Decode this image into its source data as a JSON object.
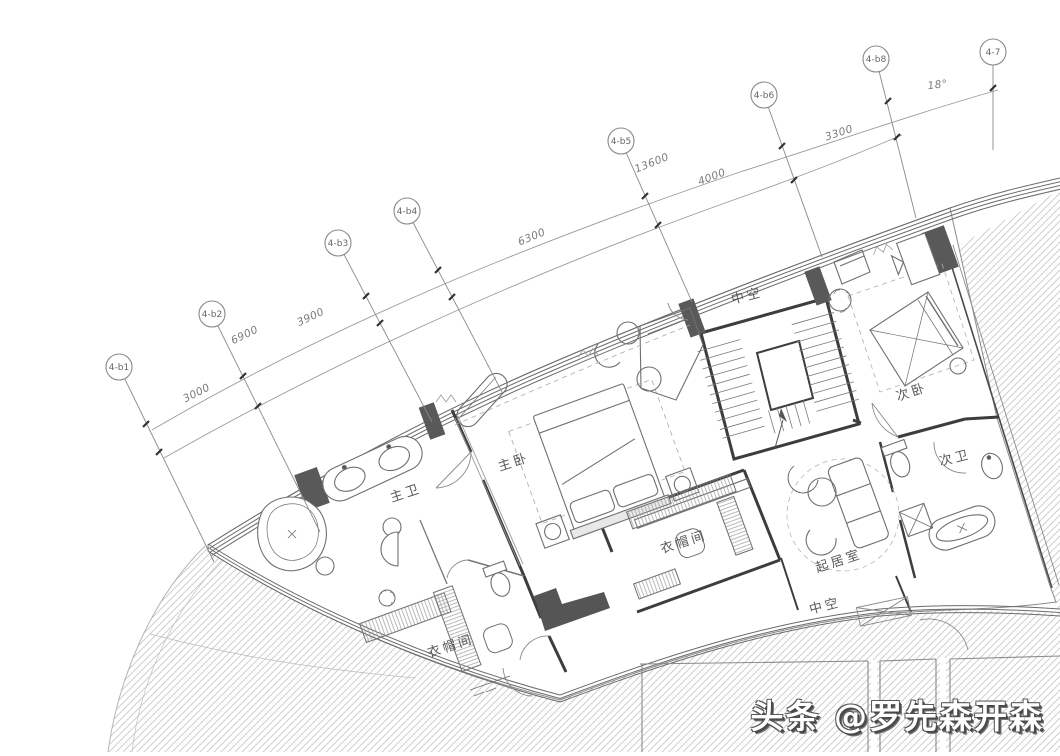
{
  "drawing": {
    "grid_axes": [
      {
        "name": "axis-4-b1",
        "label": "4-b1",
        "cx": 119,
        "cy": 367,
        "x2": 214,
        "y2": 562,
        "ticks": [
          [
            146,
            424
          ],
          [
            159,
            452
          ]
        ]
      },
      {
        "name": "axis-4-b2",
        "label": "4-b2",
        "cx": 212,
        "cy": 314,
        "x2": 320,
        "y2": 532,
        "ticks": [
          [
            243,
            376
          ],
          [
            258,
            406
          ]
        ]
      },
      {
        "name": "axis-4-b3",
        "label": "4-b3",
        "cx": 338,
        "cy": 243,
        "x2": 432,
        "y2": 422,
        "ticks": [
          [
            366,
            296
          ],
          [
            380,
            323
          ]
        ]
      },
      {
        "name": "axis-4-b4",
        "label": "4-b4",
        "cx": 407,
        "cy": 211,
        "x2": 502,
        "y2": 392,
        "ticks": [
          [
            438,
            270
          ],
          [
            452,
            297
          ]
        ]
      },
      {
        "name": "axis-4-b5",
        "label": "4-b5",
        "cx": 621,
        "cy": 141,
        "x2": 692,
        "y2": 302,
        "ticks": [
          [
            645,
            196
          ],
          [
            658,
            225
          ]
        ]
      },
      {
        "name": "axis-4-b6",
        "label": "4-b6",
        "cx": 764,
        "cy": 95,
        "x2": 822,
        "y2": 257,
        "ticks": [
          [
            782,
            146
          ],
          [
            794,
            180
          ]
        ]
      },
      {
        "name": "axis-4-b8",
        "label": "4-b8",
        "cx": 876,
        "cy": 59,
        "x2": 916,
        "y2": 218,
        "ticks": [
          [
            888,
            101
          ],
          [
            897,
            137
          ]
        ]
      },
      {
        "name": "axis-4-7",
        "label": "4-7",
        "cx": 993,
        "cy": 52,
        "x2": 993,
        "y2": 150,
        "ticks": [
          [
            993,
            88
          ]
        ]
      }
    ],
    "dim_labels": [
      {
        "name": "dim-3000",
        "text": "3000",
        "x": 198,
        "y": 396,
        "rot": -27
      },
      {
        "name": "dim-6900",
        "text": "6900",
        "x": 246,
        "y": 338,
        "rot": -26
      },
      {
        "name": "dim-3900",
        "text": "3900",
        "x": 312,
        "y": 320,
        "rot": -25
      },
      {
        "name": "dim-6300",
        "text": "6300",
        "x": 533,
        "y": 240,
        "rot": -23
      },
      {
        "name": "dim-13600",
        "text": "13600",
        "x": 653,
        "y": 166,
        "rot": -22
      },
      {
        "name": "dim-4000",
        "text": "4000",
        "x": 713,
        "y": 180,
        "rot": -21
      },
      {
        "name": "dim-3300",
        "text": "3300",
        "x": 840,
        "y": 136,
        "rot": -18
      },
      {
        "name": "dim-18deg",
        "text": "18°",
        "x": 938,
        "y": 88,
        "rot": -7
      }
    ],
    "room_labels": [
      {
        "name": "room-label-master-bath",
        "text": "主卫",
        "x": 407,
        "y": 497,
        "rot": -18
      },
      {
        "name": "room-label-master-bedroom",
        "text": "主卧",
        "x": 515,
        "y": 466,
        "rot": -18
      },
      {
        "name": "room-label-walkin-closet-west",
        "text": "衣帽间",
        "x": 452,
        "y": 650,
        "rot": -18
      },
      {
        "name": "room-label-walkin-closet-center",
        "text": "衣帽间",
        "x": 685,
        "y": 546,
        "rot": -18
      },
      {
        "name": "room-label-void-north",
        "text": "中空",
        "x": 748,
        "y": 300,
        "rot": -14
      },
      {
        "name": "room-label-void-south",
        "text": "中空",
        "x": 826,
        "y": 610,
        "rot": -14
      },
      {
        "name": "room-label-living-room",
        "text": "起居室",
        "x": 840,
        "y": 565,
        "rot": -18
      },
      {
        "name": "room-label-second-bedroom",
        "text": "次卧",
        "x": 913,
        "y": 396,
        "rot": -18
      },
      {
        "name": "room-label-second-bath",
        "text": "次卫",
        "x": 956,
        "y": 462,
        "rot": -14
      }
    ]
  },
  "watermark": {
    "prefix": "头条 ",
    "handle": "@罗先森开森"
  },
  "colors": {
    "wall": "#3d3d3d",
    "column": "#595959",
    "line_light": "#999999",
    "hatch": "#c6c6c6",
    "watermark_fill": "#ffffff",
    "watermark_outline": "#4a4a4a"
  }
}
